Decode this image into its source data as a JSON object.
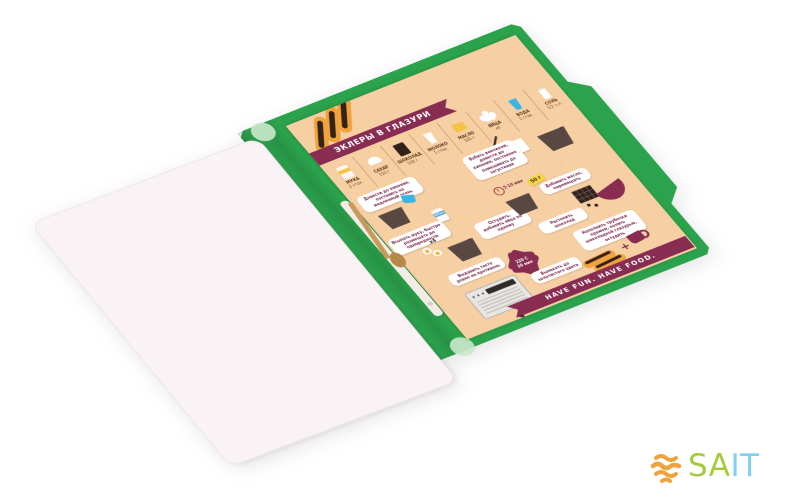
{
  "branding": {
    "logo_sa": "SA",
    "logo_it": "IT"
  },
  "colors": {
    "folder_green": "#2BA24C",
    "page_peach": "#F6CFA3",
    "accent_maroon": "#882C52",
    "logo_orange": "#F0A23C",
    "logo_green": "#A4CB3E",
    "logo_blue": "#7FD1F2"
  },
  "infographic": {
    "title": "ЭКЛЕРЫ В ГЛАЗУРИ",
    "ingredients": [
      {
        "name": "МУКА",
        "qty": "2 стак."
      },
      {
        "name": "САХАР",
        "qty": "150 г"
      },
      {
        "name": "ШОКОЛАД",
        "qty": "100 г"
      },
      {
        "name": "МОЛОКО",
        "qty": "1 стак."
      },
      {
        "name": "МАСЛО",
        "qty": "100 г"
      },
      {
        "name": "ЯЙЦА",
        "qty": "х6"
      },
      {
        "name": "ВОДА",
        "qty": "1 стак."
      },
      {
        "name": "СОЛЬ",
        "qty": "1/2 ч.л."
      }
    ],
    "steps": [
      {
        "text": "Довести до кипения, поставить на медленный огонь"
      },
      {
        "text": "Всыпать муку, быстро размешать до однородности"
      },
      {
        "text": "Остудить, добавить яйца по одному"
      },
      {
        "text": "Выдавить тесто ровно на противень"
      },
      {
        "text": "Выпекать до золотистого цвета"
      },
      {
        "text": "Взбить венчиком, довести до кипения, постоянно помешивать до загустения"
      },
      {
        "text": "Добавить масло, перемешать"
      },
      {
        "text": "Растопить шоколад"
      },
      {
        "text": "Наполнить трубочки кремом, полить шоколадной глазурью, остудить"
      }
    ],
    "labels": {
      "eggs_multiplier": "х4",
      "whisk_time": "5-10 мин",
      "butter_weight": "50 г",
      "bake_temp": "220 С",
      "bake_time": "30 мин",
      "plus": "+",
      "flour_pack": "МУКА"
    },
    "footer": "HAVE FUN. HAVE FOOD."
  }
}
